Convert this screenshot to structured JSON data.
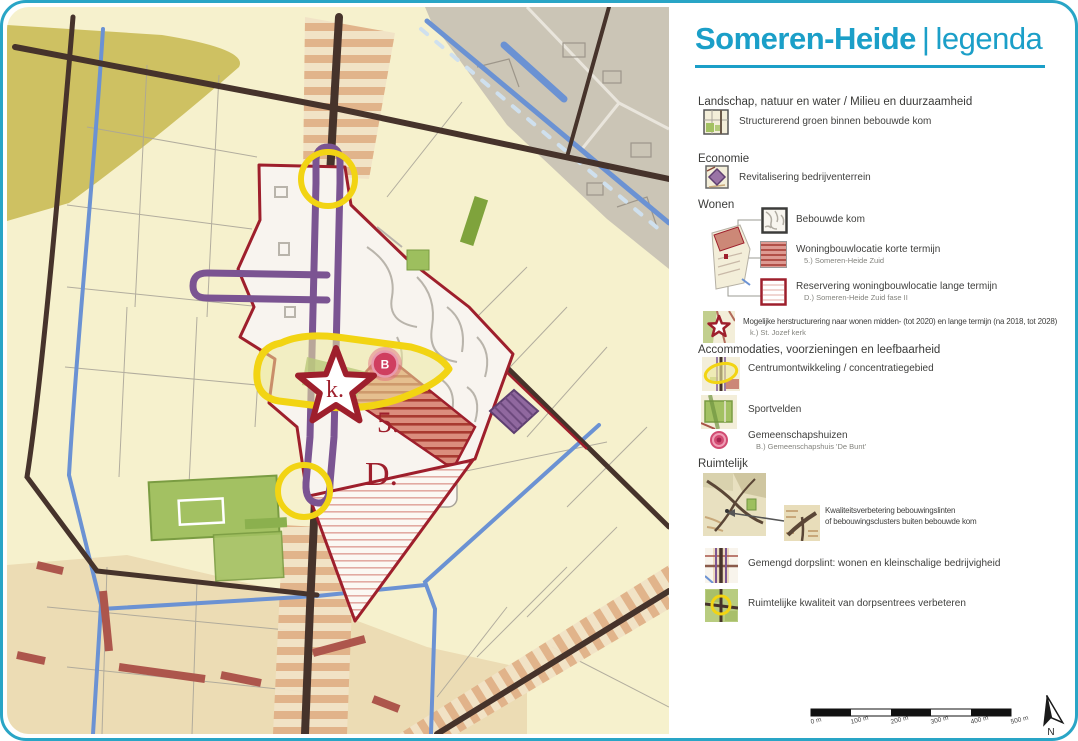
{
  "title": {
    "name": "Someren-Heide",
    "separator": "|",
    "suffix": "legenda"
  },
  "colors": {
    "accent": "#1b9fc8",
    "map_red": "#9e1f2c",
    "map_purple": "#7b5492",
    "map_yellow": "#f2d413",
    "map_green": "#a3c162",
    "map_blue": "#6b92d3",
    "road_brown": "#46332b",
    "badge_pink": "#cf3e60",
    "cream": "#f6f1cd"
  },
  "map": {
    "label_star": "k.",
    "label_badge": "B",
    "label_area_short": "5.",
    "label_area_long": "D."
  },
  "legend": {
    "section_landschap": "Landschap, natuur en water / Milieu en duurzaamheid",
    "item_groen": "Structurerend groen binnen bebouwde kom",
    "section_economie": "Economie",
    "item_revitalisering": "Revitalisering bedrijventerrein",
    "section_wonen": "Wonen",
    "item_bebouwde_kom": "Bebouwde kom",
    "item_korte_termijn": "Woningbouwlocatie korte termijn",
    "sub_korte_termijn": "5.) Someren-Heide Zuid",
    "item_lange_termijn": "Reservering woningbouwlocatie lange termijn",
    "sub_lange_termijn": "D.) Someren-Heide Zuid fase II",
    "item_herstructurering": "Mogelijke herstructurering naar wonen midden- (tot 2020) en lange termijn (na 2018, tot 2028)",
    "sub_herstructurering": "k.) St. Jozef kerk",
    "section_accommodaties": "Accommodaties, voorzieningen en leefbaarheid",
    "item_centrum": "Centrumontwikkeling / concentratiegebied",
    "item_sportvelden": "Sportvelden",
    "item_gemeenschapshuizen": "Gemeenschapshuizen",
    "sub_gemeenschapshuizen": "B.) Gemeenschapshuis 'De Bunt'",
    "section_ruimtelijk": "Ruimtelijk",
    "item_kwaliteit_1": "Kwaliteitsverbetering bebouwingslinten",
    "item_kwaliteit_2": "of bebouwingsclusters buiten bebouwde kom",
    "item_dorpslint": "Gemengd dorpslint: wonen en kleinschalige bedrijvigheid",
    "item_dorpsentrees": "Ruimtelijke kwaliteit van dorpsentrees verbeteren"
  },
  "scalebar": {
    "labels": [
      "0 m",
      "100 m",
      "200 m",
      "300 m",
      "400 m",
      "500 m"
    ]
  },
  "compass": {
    "label": "N"
  }
}
